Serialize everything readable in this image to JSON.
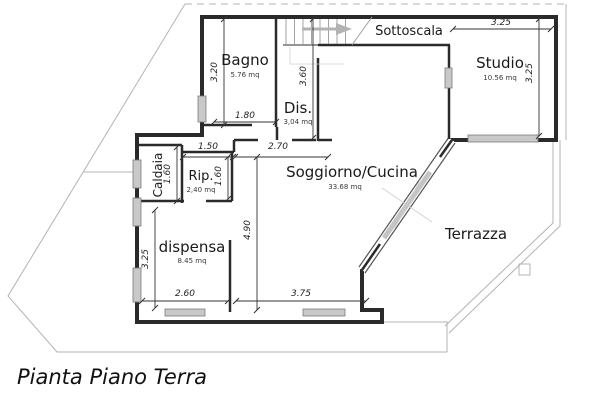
{
  "title": "Pianta Piano Terra",
  "rooms": {
    "bagno": {
      "label": "Bagno",
      "area": "5.76 mq"
    },
    "dis": {
      "label": "Dis.",
      "area": "3,04 mq"
    },
    "sottoscala": {
      "label": "Sottoscala"
    },
    "studio": {
      "label": "Studio",
      "area": "10.56 mq"
    },
    "caldaia": {
      "label": "Caldaia"
    },
    "rip": {
      "label": "Rip.",
      "area": "2,40 mq"
    },
    "soggiorno": {
      "label": "Soggiorno/Cucina",
      "area": "33.68 mq"
    },
    "dispensa": {
      "label": "dispensa",
      "area": "8.45 mq"
    },
    "terrazza": {
      "label": "Terrazza"
    }
  },
  "dims": {
    "bagno_height": "3.20",
    "bagno_width": "1.80",
    "dis_height": "3.60",
    "studio_width": "3.25",
    "studio_height": "3.25",
    "rip_width": "1.50",
    "soggiorno_top_width": "2.70",
    "caldaia_height": "1.60",
    "rip_height": "1.60",
    "soggiorno_height": "4.90",
    "dispensa_height": "3.25",
    "dispensa_width": "2.60",
    "soggiorno_width": "3.75"
  }
}
